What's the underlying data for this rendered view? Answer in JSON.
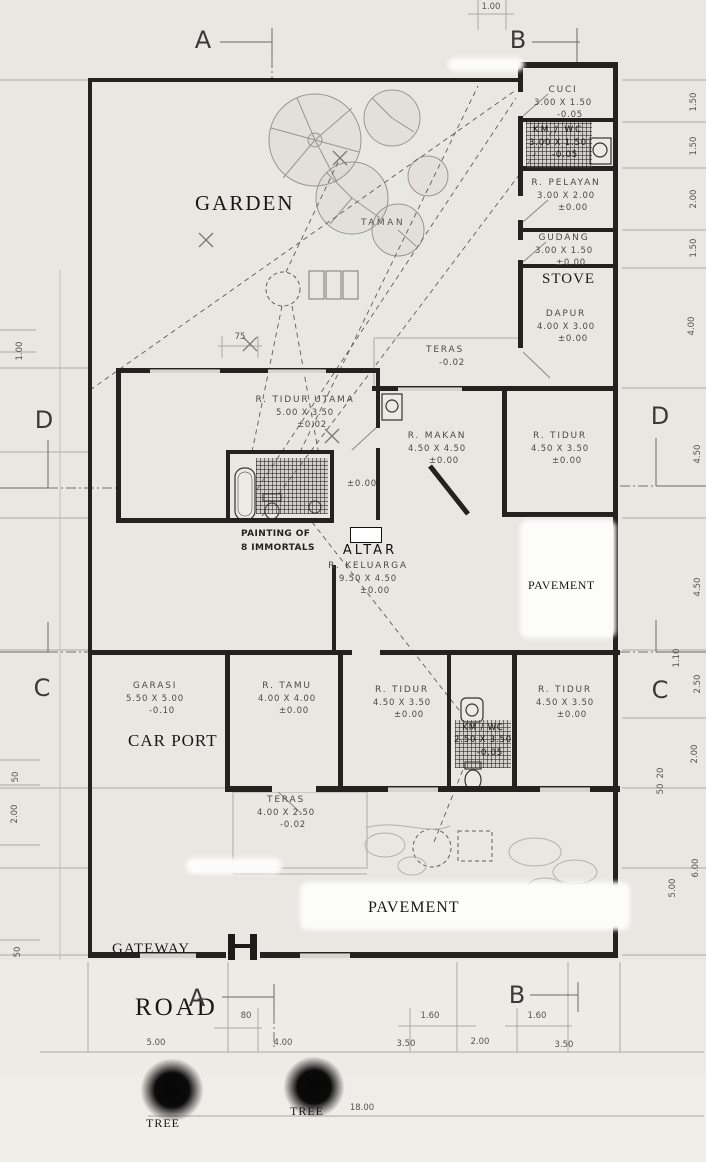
{
  "plan": {
    "rooms": [
      {
        "name": "CUCI",
        "dims": "3.00 X 1.50",
        "level": "-0.05"
      },
      {
        "name": "KM / WC",
        "dims": "3.00 X 1.50",
        "level": "-0.05"
      },
      {
        "name": "R. PELAYAN",
        "dims": "3.00 X 2.00",
        "level": "±0.00"
      },
      {
        "name": "GUDANG",
        "dims": "3.00 X 1.50",
        "level": "±0.00"
      },
      {
        "name": "DAPUR",
        "dims": "4.00 X 3.00",
        "level": "±0.00"
      },
      {
        "name": "TERAS",
        "dims": "",
        "level": "-0.02"
      },
      {
        "name": "R. TIDUR UTAMA",
        "dims": "5.00 X 3.50",
        "level": "±0.02"
      },
      {
        "name": "R. MAKAN",
        "dims": "4.50 X 4.50",
        "level": "±0.00"
      },
      {
        "name": "R. TIDUR",
        "dims": "4.50 X 3.50",
        "level": "±0.00"
      },
      {
        "name": "R. KELUARGA",
        "dims": "9.50 X 4.50",
        "level": "±0.00"
      },
      {
        "name": "GARASI",
        "dims": "5.50 X 5.00",
        "level": "-0.10"
      },
      {
        "name": "R. TAMU",
        "dims": "4.00 X 4.00",
        "level": "±0.00"
      },
      {
        "name": "R. TIDUR",
        "dims": "4.50 X 3.50",
        "level": "±0.00"
      },
      {
        "name": "KM / WC",
        "dims": "2.50 X 3.50",
        "level": "-0.05"
      },
      {
        "name": "R. TIDUR",
        "dims": "4.50 X 3.50",
        "level": "±0.00"
      },
      {
        "name": "TERAS",
        "dims": "4.00 X 2.50",
        "level": "-0.02"
      }
    ],
    "bath_level": "±0.00"
  },
  "annotations": {
    "garden": "GARDEN",
    "taman": "TAMAN",
    "stove": "STOVE",
    "painting_line1": "PAINTING OF",
    "painting_line2": "8 IMMORTALS",
    "altar": "ALTAR",
    "pavement_right": "PAVEMENT",
    "pavement_bottom": "PAVEMENT",
    "car_port": "CAR PORT",
    "gateway": "GATEWAY",
    "road": "ROAD",
    "tree_left": "TREE",
    "tree_right": "TREE"
  },
  "grid": {
    "a": "A",
    "b": "B",
    "c": "C",
    "d": "D"
  },
  "dims": {
    "top": [
      "1.00"
    ],
    "wall_offset": "75",
    "left": [
      "1.00",
      "50",
      "2.00",
      "50"
    ],
    "right": [
      "1.50",
      "1.50",
      "2.00",
      "1.50",
      "4.00",
      "4.50",
      "4.50",
      "1.10",
      "2.50",
      "2.00",
      "20",
      "50",
      "6.00",
      "5.00"
    ],
    "bottom_upper": [
      "80",
      "1.60",
      "1.60"
    ],
    "bottom_lower": [
      "5.00",
      "4.00",
      "3.50",
      "2.00",
      "3.50"
    ],
    "site_width": "18.00"
  },
  "colors": {
    "paper": "#e9e7e2",
    "wall": "#23221f",
    "pencil": "#aaa8a2",
    "ink": "#3f3f3c"
  }
}
